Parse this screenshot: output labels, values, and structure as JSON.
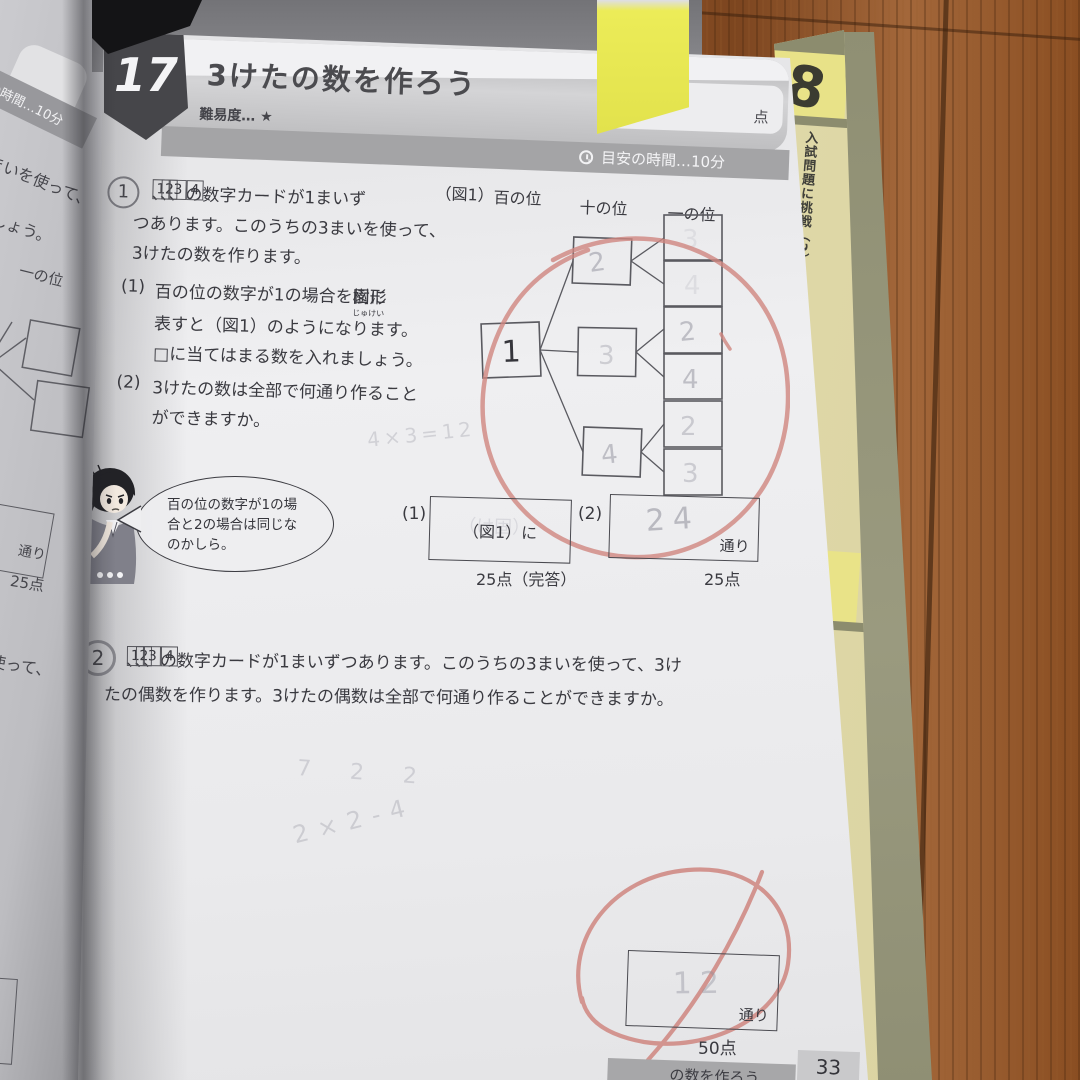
{
  "side": {
    "tab_title": "入試問題に挑戦（2）",
    "tab_number_top": "28",
    "tab_number_mid": "3"
  },
  "left_page": {
    "score_unit": "点",
    "time_band": "安の時間…10分",
    "line1": "まいを使って、",
    "line2": "しょう。",
    "line3": "一の位",
    "unit": "通り",
    "points": "25点",
    "line4": "使って、"
  },
  "page": {
    "header": {
      "number": "17",
      "title": "3けたの数を作ろう",
      "difficulty": "難易度… ★",
      "score_unit": "点",
      "time": "目安の時間…10分"
    },
    "p1": {
      "number": "1",
      "cards": [
        "1",
        "2",
        "3",
        "4"
      ],
      "sep": "、",
      "l1": "の数字カードが1まいず",
      "l2": "つあります。このうちの3まいを使って、",
      "l3": "3けたの数を作ります。",
      "q1_label": "(1)",
      "q1_l1a": "百の位の数字が1の場合を",
      "q1_ruby": "樹形",
      "q1_rt": "じゅけい",
      "q1_l1b": "図に",
      "q1_l2": "表すと（図1）のようになります。",
      "q1_l3": "□に当てはまる数を入れましょう。",
      "q2_label": "(2)",
      "q2_l1": "3けたの数は全部で何通り作ること",
      "q2_l2": "ができますか。"
    },
    "figure": {
      "label": "（図1）",
      "col_hundreds": "百の位",
      "col_tens": "十の位",
      "col_ones": "一の位",
      "root": "1",
      "tens": [
        "2",
        "3",
        "4"
      ],
      "ones": [
        "3",
        "4",
        "2",
        "4",
        "2",
        "3"
      ]
    },
    "bubble": {
      "l1": "百の位の数字が1の場",
      "l2": "合と2の場合は同じな",
      "l3": "のかしら。"
    },
    "ans1": {
      "label1": "(1)",
      "box1": "（図1）に",
      "ghost1": "（け固）",
      "points1": "25点（完答）",
      "label2": "(2)",
      "written2": "24",
      "unit2": "通り",
      "points2": "25点"
    },
    "p2": {
      "number": "2",
      "cards": [
        "1",
        "2",
        "3",
        "4"
      ],
      "sep": "、",
      "l1": "の数字カードが1まいずつあります。このうちの3まいを使って、3け",
      "l2": "たの偶数を作ります。3けたの偶数は全部で何通り作ることができますか。"
    },
    "scribbles": {
      "s1": "4×3=12",
      "s2": "7 2 2",
      "s3": "2×2-4"
    },
    "ans2": {
      "written": "12",
      "unit": "通り",
      "points": "50点"
    },
    "footer": {
      "title": "の数を作ろう",
      "page_number": "33"
    }
  },
  "colors": {
    "accent_red": "#cf8680",
    "pencil": "#8f8f9b",
    "sticky_yellow": "#e9e955",
    "wood": "#9a5c2c"
  }
}
